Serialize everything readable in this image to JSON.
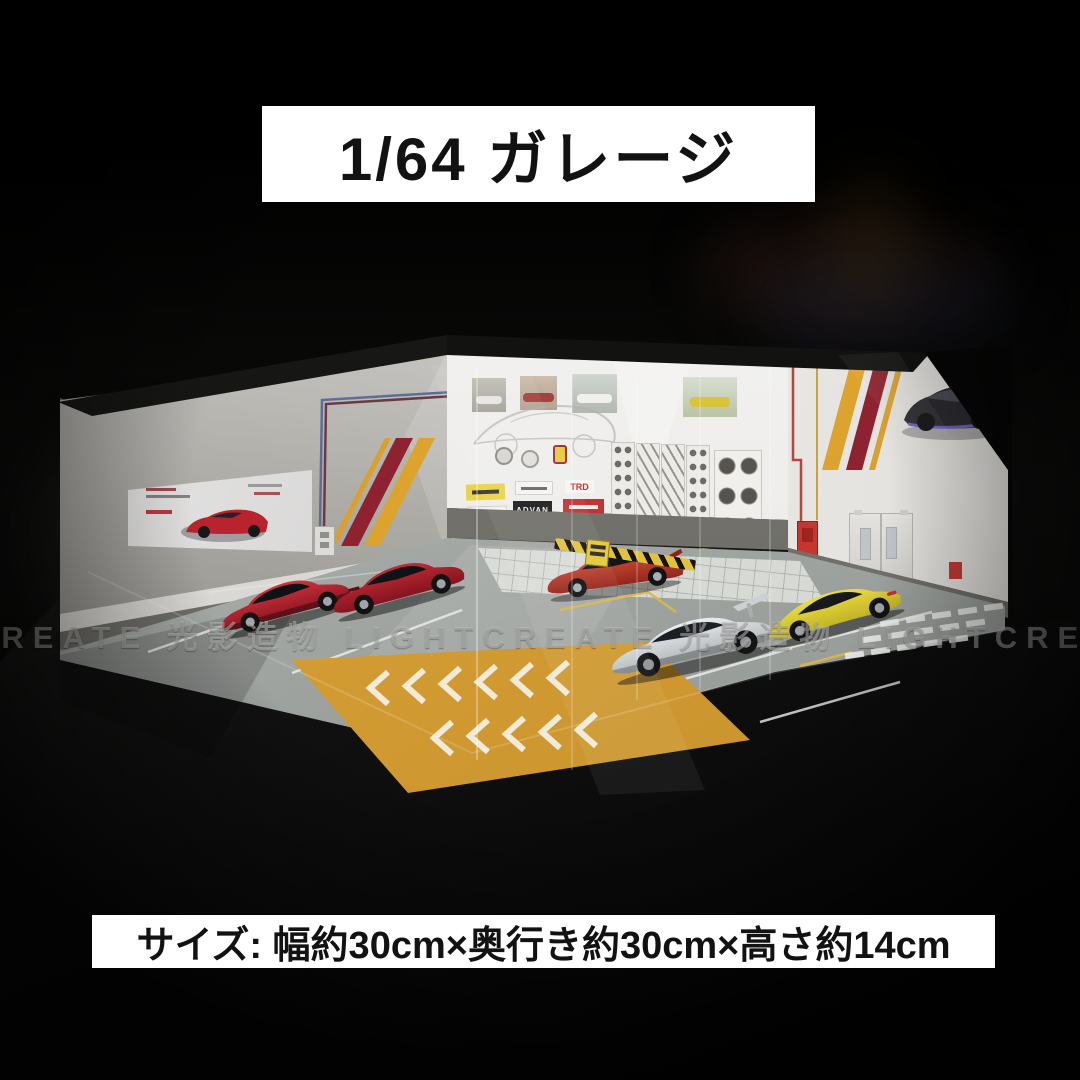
{
  "banners": {
    "top": {
      "text": "1/64 ガレージ",
      "bg": "#ffffff",
      "fg": "#121212"
    },
    "bottom": {
      "text": "サイズ: 幅約30cm×奥行き約30cm×高さ約14cm",
      "bg": "#ffffff",
      "fg": "#121212"
    }
  },
  "watermark": {
    "text": "CREATE 光影造物 LIGHTCREATE 光影造物 LIGHTCREATE 光影造物 LIGH",
    "color": "#c6c6c3"
  },
  "stickers": {
    "advan": "ADVAN",
    "trd": "TRD"
  },
  "scene": {
    "description": "LED-lit 1/64 scale garage corner diorama displaying five diecast model cars",
    "colors": {
      "stripe_red": "#8e2230",
      "stripe_yellow": "#d99f2e",
      "orange_floor_zone": "#d9a238",
      "wall_white": "#f2f1ef",
      "wall_gray": "#a8a6a1",
      "floor_gray": "#a4a8a5",
      "car_red_laferrari": "#b31f2b",
      "car_red_f12": "#a81e28",
      "car_red_service": "#c23a2c",
      "car_silver_race": "#d3d7d9",
      "car_yellow_porsche": "#ddd231",
      "door_gray": "#d8d7d3",
      "fire_box_red": "#c4362e",
      "exit_sign_green": "#3fae6a",
      "hazard_yellow": "#e2c23c"
    }
  }
}
